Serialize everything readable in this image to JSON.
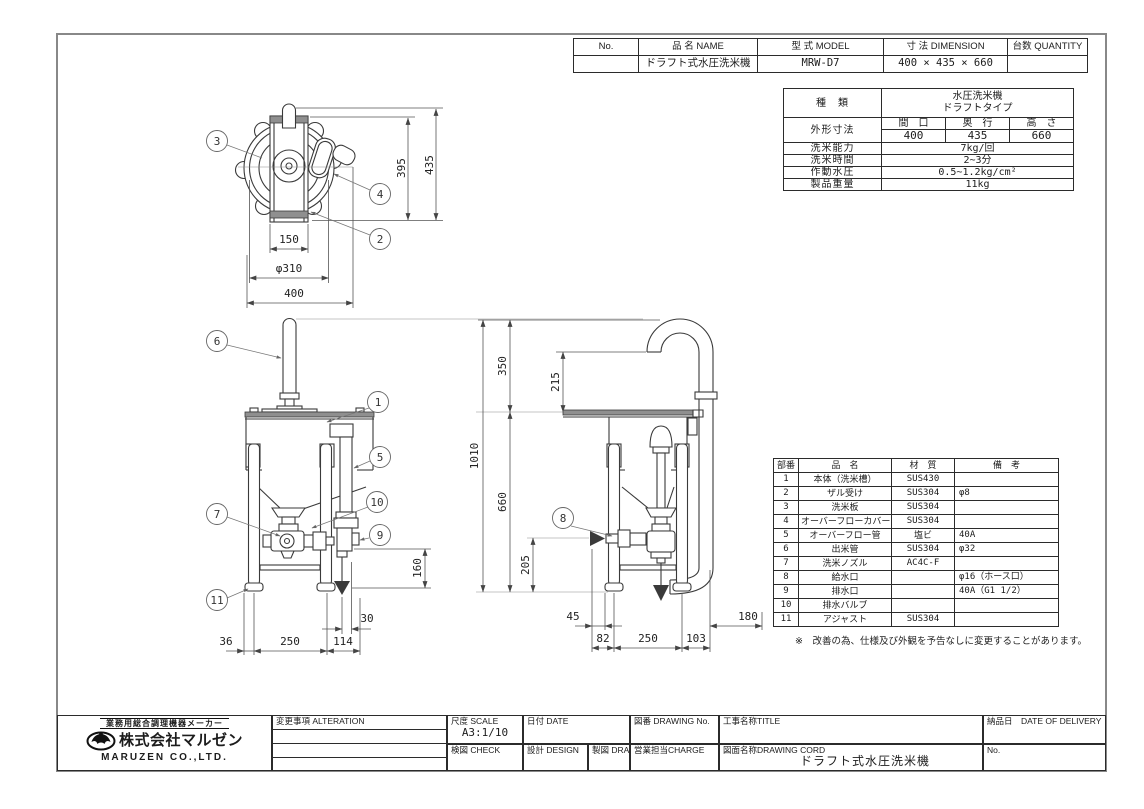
{
  "order_table": {
    "col_no": "No.",
    "col_name": "品 名  NAME",
    "col_model": "型 式  MODEL",
    "col_dimension": "寸 法  DIMENSION",
    "col_quantity": "台数 QUANTITY",
    "row": {
      "no": "",
      "name": "ドラフト式水圧洗米機",
      "model": "MRW-D7",
      "dimension": "400 × 435 × 660",
      "quantity": ""
    }
  },
  "spec_table": {
    "kind_label": "種　類",
    "kind_value_line1": "水圧洗米機",
    "kind_value_line2": "ドラフトタイプ",
    "outline_label": "外形寸法",
    "width_label": "間　口",
    "depth_label": "奥　行",
    "height_label": "高　さ",
    "width_value": "400",
    "depth_value": "435",
    "height_value": "660",
    "capacity_label": "洗米能力",
    "capacity_value": "7kg/回",
    "time_label": "洗米時間",
    "time_value": "2~3分",
    "pressure_label": "作動水圧",
    "pressure_value": "0.5~1.2kg/cm²",
    "weight_label": "製品重量",
    "weight_value": "11kg"
  },
  "parts_table": {
    "col_no": "部番",
    "col_name": "品　名",
    "col_material": "材　質",
    "col_note": "備　考",
    "rows": [
      {
        "no": "1",
        "name": "本体（洗米槽）",
        "material": "SUS430",
        "note": ""
      },
      {
        "no": "2",
        "name": "ザル受け",
        "material": "SUS304",
        "note": "φ8"
      },
      {
        "no": "3",
        "name": "洗米板",
        "material": "SUS304",
        "note": ""
      },
      {
        "no": "4",
        "name": "オーバーフローカバー",
        "material": "SUS304",
        "note": ""
      },
      {
        "no": "5",
        "name": "オーバーフロー管",
        "material": "塩ビ",
        "note": "40A"
      },
      {
        "no": "6",
        "name": "出米管",
        "material": "SUS304",
        "note": "φ32"
      },
      {
        "no": "7",
        "name": "洗米ノズル",
        "material": "AC4C-F",
        "note": ""
      },
      {
        "no": "8",
        "name": "給水口",
        "material": "",
        "note": "φ16（ホース口）"
      },
      {
        "no": "9",
        "name": "排水口",
        "material": "",
        "note": "40A（G1 1/2）"
      },
      {
        "no": "10",
        "name": "排水バルブ",
        "material": "",
        "note": ""
      },
      {
        "no": "11",
        "name": "アジャスト",
        "material": "SUS304",
        "note": ""
      }
    ]
  },
  "note": "※　改善の為、仕様及び外観を予告なしに変更することがあります。",
  "title_block": {
    "maker_tagline": "業務用総合調理機器メーカー",
    "company_jp": "株式会社マルゼン",
    "company_en": "MARUZEN CO.,LTD.",
    "alteration_label": "変更事項 ALTERATION",
    "scale_label": "尺度 SCALE",
    "scale_value": "A3:1/10",
    "date_label": "日付 DATE",
    "drawing_no_label": "図番 DRAWING No.",
    "title_label": "工事名称TITLE",
    "check_label": "検図 CHECK",
    "design_label": "設計 DESIGN",
    "draw_label": "製図 DRAW",
    "charge_label": "営業担当CHARGE",
    "drawing_cord_label": "図面名称DRAWING CORD",
    "drawing_cord_value": "ドラフト式水圧洗米機",
    "delivery_label": "納品日　DATE OF DELIVERY",
    "no_label": "No."
  },
  "drawing": {
    "colors": {
      "line": "#3a3a3a",
      "dim": "#555555",
      "gray_fill": "#8f8f8f",
      "frame": "#888888"
    },
    "callouts": {
      "n1": "1",
      "n2": "2",
      "n3": "3",
      "n4": "4",
      "n5": "5",
      "n6": "6",
      "n7": "7",
      "n8": "8",
      "n9": "9",
      "n10": "10",
      "n11": "11"
    },
    "top_dims": {
      "channel": "150",
      "diameter": "φ310",
      "width": "400",
      "inner_depth": "395",
      "depth": "435"
    },
    "front_dims": {
      "drain_height": "160",
      "drain_offset": "30",
      "left_offset": "36",
      "leg_span": "250",
      "right_offset": "114"
    },
    "side_dims": {
      "total_height": "1010",
      "spout_height": "350",
      "spout_clearance": "215",
      "body_height": "660",
      "inlet_height": "205",
      "front_offset": "45",
      "front_leg_offset": "82",
      "leg_span": "250",
      "rear_offset": "103",
      "rear_clearance": "180"
    }
  }
}
